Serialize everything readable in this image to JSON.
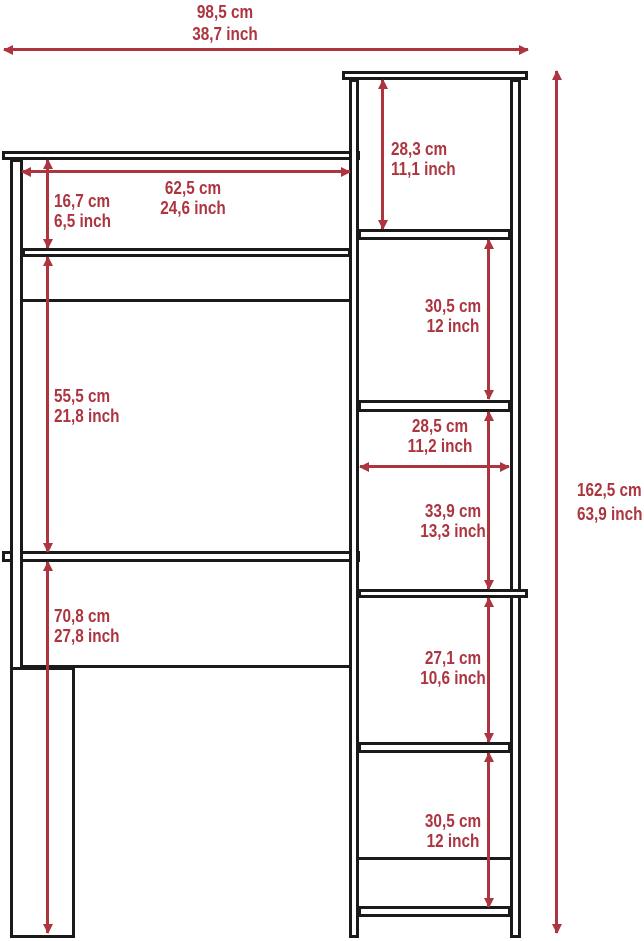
{
  "diagram_type": "furniture-dimension-drawing",
  "colors": {
    "dimension_red": "#AC3540",
    "outline_black": "#1A1A1A",
    "background": "#FFFFFF"
  },
  "dimensions": {
    "overall_width": {
      "cm": "98,5 cm",
      "inch": "38,7 inch"
    },
    "top_cubby_height": {
      "cm": "28,3 cm",
      "inch": "11,1 inch"
    },
    "hutch_interior_width": {
      "cm": "62,5 cm",
      "inch": "24,6 inch"
    },
    "hutch_cubby_height": {
      "cm": "16,7 cm",
      "inch": "6,5 inch"
    },
    "upper_shelf_gap": {
      "cm": "30,5 cm",
      "inch": "12 inch"
    },
    "hutch_to_desktop": {
      "cm": "55,5 cm",
      "inch": "21,8 inch"
    },
    "shelf_interior_width": {
      "cm": "28,5 cm",
      "inch": "11,2 inch"
    },
    "middle_shelf_gap": {
      "cm": "33,9 cm",
      "inch": "13,3 inch"
    },
    "overall_height": {
      "cm": "162,5 cm",
      "inch": "63,9 inch"
    },
    "below_desk_shelf_gap": {
      "cm": "27,1 cm",
      "inch": "10,6 inch"
    },
    "desktop_height": {
      "cm": "70,8 cm",
      "inch": "27,8 inch"
    },
    "bottom_shelf_gap": {
      "cm": "30,5 cm",
      "inch": "12 inch"
    }
  }
}
